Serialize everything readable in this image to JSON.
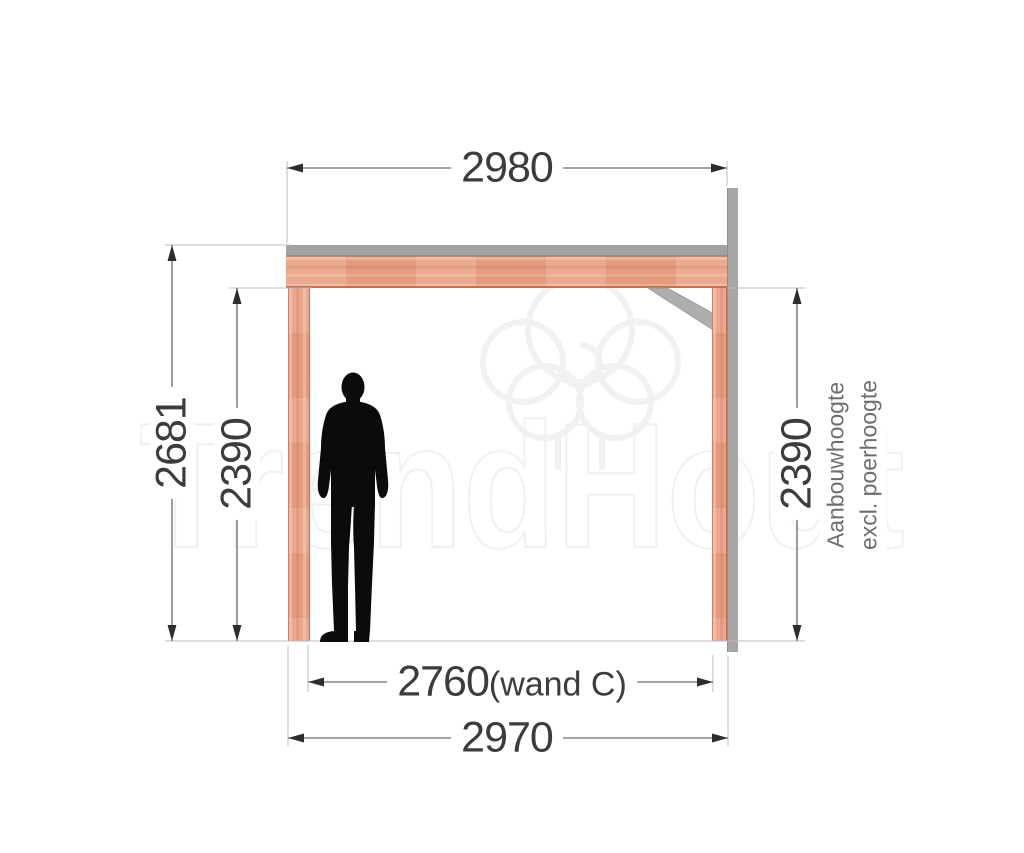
{
  "watermark": {
    "brand": "TrendHout",
    "logo": "tree-logo-icon",
    "outline_color": "#f1f1f1"
  },
  "figure": {
    "name": "person-silhouette",
    "color": "#0b0b0b"
  },
  "dimensions": {
    "top_width": "2980",
    "left_outer_height": "2681",
    "left_inner_height": "2390",
    "right_inner_height": "2390",
    "right_note_line1": "Aanbouwhoogte",
    "right_note_line2": "excl. poerhoogte",
    "bottom_inner_width": "2760",
    "bottom_inner_suffix": "(wand C)",
    "bottom_outer_width": "2970"
  },
  "colors": {
    "wood": "#e8a184",
    "wood_edge": "#c4714f",
    "steel_gray": "#a6a6a6",
    "dimension_line": "#4a4a4a",
    "extension_line": "#bdbdbd",
    "label_text": "#3c3c3c",
    "note_text": "#6e6e6e",
    "background": "#ffffff"
  }
}
